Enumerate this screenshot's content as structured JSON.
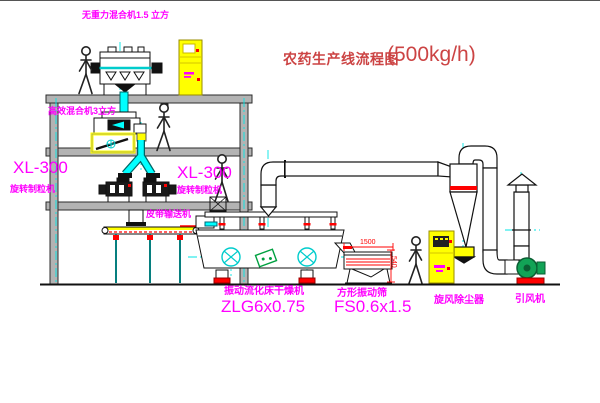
{
  "diagram": {
    "title": {
      "text": "农药生产线流程图",
      "capacity": "(500kg/h)"
    },
    "equipment_labels": {
      "gravity_free_mixer": "无重力混合机1.5 立方",
      "high_efficiency_mixer": "高效混合机3立方",
      "granulator_left_model": "XL-300",
      "granulator_left_name": "旋转制粒机",
      "granulator_mid_model": "XL-300",
      "granulator_mid_name": "旋转制粒机",
      "belt_conveyor": "皮带输送机",
      "fluid_bed_dryer_name": "振动流化床干燥机",
      "fluid_bed_dryer_model": "ZLG6x0.75",
      "square_sieve_name": "方形振动筛",
      "square_sieve_model": "FS0.6x1.5",
      "cyclone": "旋风除尘器",
      "induced_draft_fan": "引风机"
    },
    "dimensions": {
      "sieve_length": "1500",
      "sieve_height": "540"
    },
    "colors": {
      "label_magenta": "#ff00ff",
      "title_red": "#cc4444",
      "dimension_red": "#ff0000",
      "duct_cyan": "#00ffff",
      "cabinet_yellow": "#ffff00",
      "fan_green": "#12a356",
      "structure_gray": "#b3b3b3",
      "line_black": "#111111"
    }
  }
}
